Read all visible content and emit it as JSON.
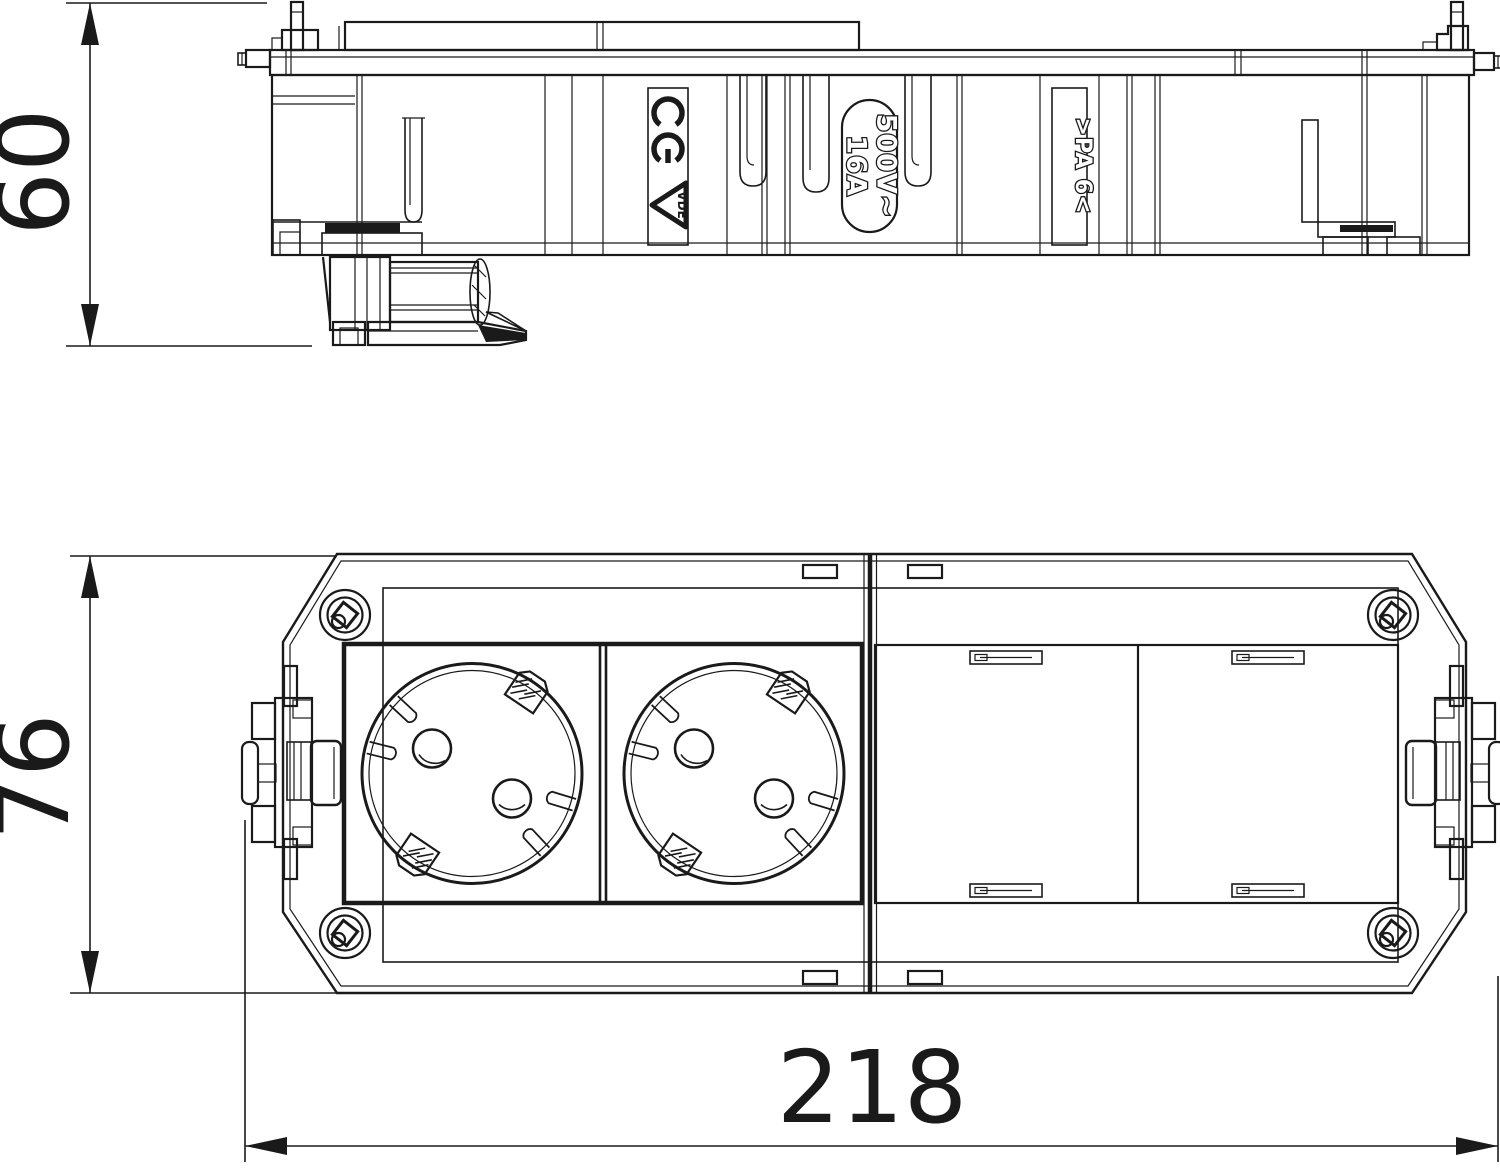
{
  "colors": {
    "line": "#1a1a1a",
    "background": "#ffffff"
  },
  "dimensions": {
    "height": "60",
    "depth": "76",
    "width": "218"
  },
  "markings": {
    "ce": "CE",
    "vde": "VDE",
    "voltage": "500V~",
    "current": "16A",
    "material": ">PA 6<"
  }
}
